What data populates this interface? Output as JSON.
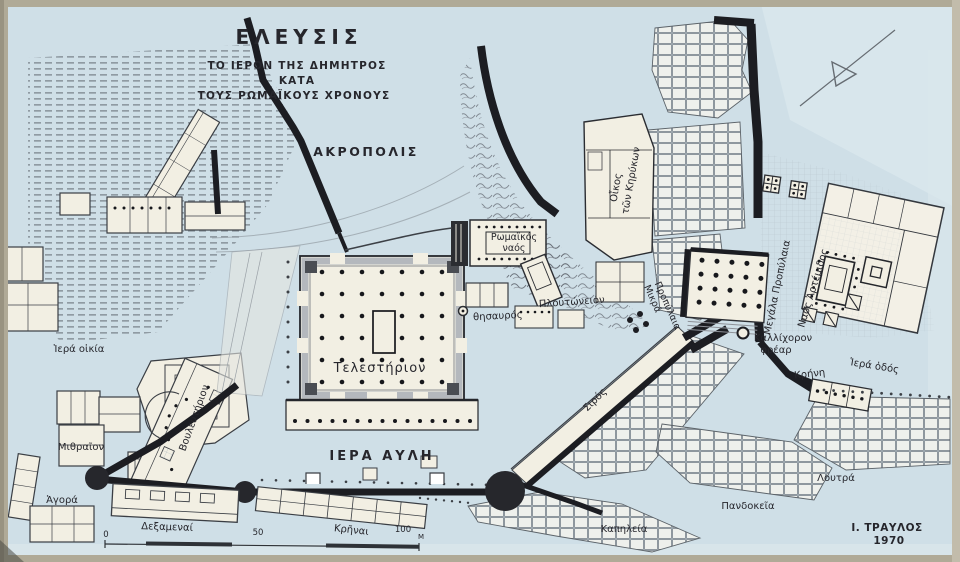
{
  "map": {
    "title": "ΕΛΕΥΣΙΣ",
    "subtitle_line1": "ΤΟ ΙΕΡΟΝ ΤΗΣ ΔΗΜΗΤΡΟΣ",
    "subtitle_line2": "ΚΑΤΑ",
    "subtitle_line3": "ΤΟΥΣ ΡΩΜΑΪΚΟΥΣ ΧΡΟΝΟΥΣ",
    "credit_line1": "Ι. ΤΡΑΥΛΟΣ",
    "credit_line2": "1970"
  },
  "labels": {
    "akropolis": "ΑΚΡΟΠΟΛΙΣ",
    "hiera_aule": "ΙΕΡΑ ΑΥΛΗ",
    "telesterion": "Τελεστήριον",
    "roman_temple_line1": "Ρωμαϊκός",
    "roman_temple_line2": "ναός",
    "oikos_line1": "Οἶκος",
    "oikos_line2": "τῶν Κηρύκων",
    "ploutoneion": "Πλουτώνειον",
    "thesauros": "θησαυρός",
    "mikra_line1": "Μικρά",
    "mikra_line2": "Προπύλαια",
    "megala": "Μεγάλα Προπύλαια",
    "naos_artemidos": "Ναός Ἀρτέμιδος",
    "kallichoron_line1": "Καλλίχορον",
    "kallichoron_line2": "φρέαρ",
    "krene": "Κρήνη",
    "hiera_hodos": "Ἱερά ὁδός",
    "hiera_oikia": "Ἱερά οἰκία",
    "bouleuterion": "Βουλευτήριον",
    "mithraion": "Μιθραῖον",
    "agora": "Ἀγορά",
    "dexamenai": "Δεξαμεναί",
    "krenai": "Κρῆναι",
    "siros": "Σιρός",
    "kapeleia": "Καπηλεία",
    "pandokeia": "Πανδοκεῖα",
    "loutra": "Λουτρά"
  },
  "scale_bar": {
    "zero": "0",
    "fifty": "50",
    "hundred": "100",
    "unit": "Μ"
  },
  "colors": {
    "paper_blue": "#cfdfe7",
    "building_cream": "#f2efe3",
    "wall_black": "#1c1d22",
    "ink": "#26262c",
    "frame_tan": "#b0aa97"
  }
}
